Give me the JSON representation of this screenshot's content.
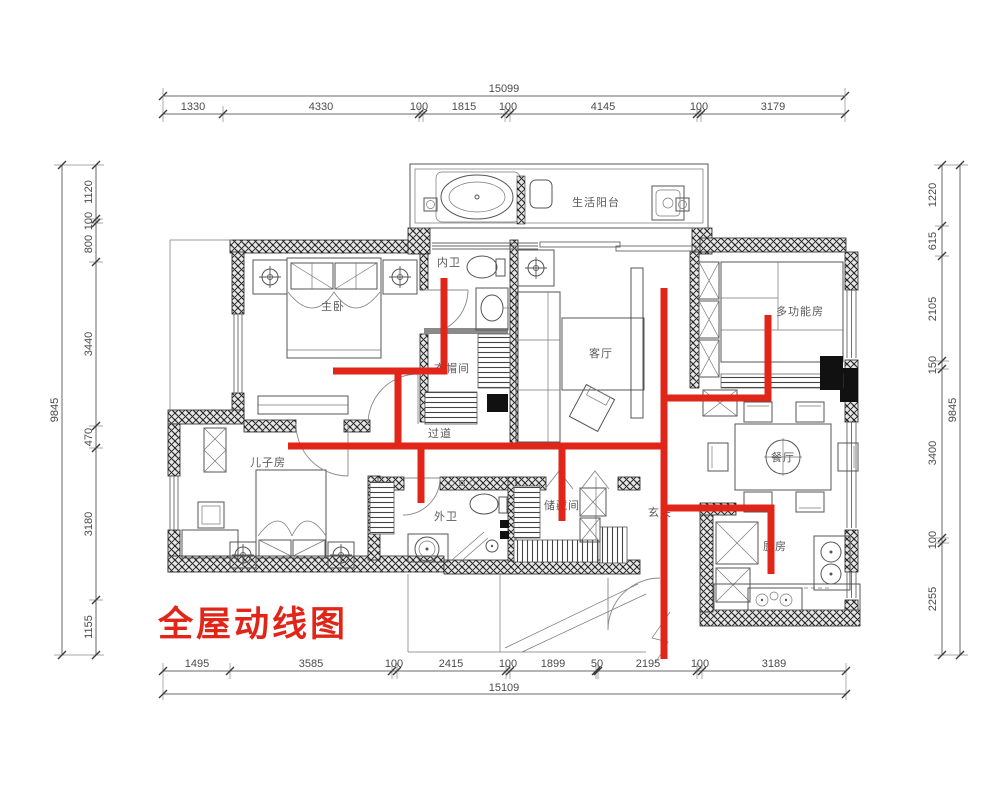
{
  "title": "全屋动线图",
  "colors": {
    "circulation": "#e12619",
    "accent": "#e12619",
    "plan_line": "#555555"
  },
  "rooms": {
    "master": "主卧",
    "ensuite": "内卫",
    "cloakroom": "衣帽间",
    "living": "客厅",
    "multifunction": "多功能房",
    "dining": "餐厅",
    "kitchen": "厨房",
    "entry": "玄关",
    "corridor": "过道",
    "kids": "儿子房",
    "guest_bath": "外卫",
    "storage": "储藏间",
    "balcony": "生活阳台"
  },
  "dimensions": {
    "top": {
      "total": "15099",
      "segments": [
        "1330",
        "4330",
        "100",
        "1815",
        "100",
        "4145",
        "100",
        "3179"
      ]
    },
    "bottom": {
      "total": "15109",
      "segments": [
        "1495",
        "3585",
        "100",
        "2415",
        "100",
        "1899",
        "50",
        "2195",
        "100",
        "3189"
      ]
    },
    "left": {
      "total": "9845",
      "segments": [
        "1120",
        "100",
        "800",
        "3440",
        "470",
        "3180",
        "1155"
      ]
    },
    "right": {
      "total": "9845",
      "segments": [
        "1220",
        "615",
        "2105",
        "150",
        "3400",
        "100",
        "2255"
      ]
    }
  }
}
